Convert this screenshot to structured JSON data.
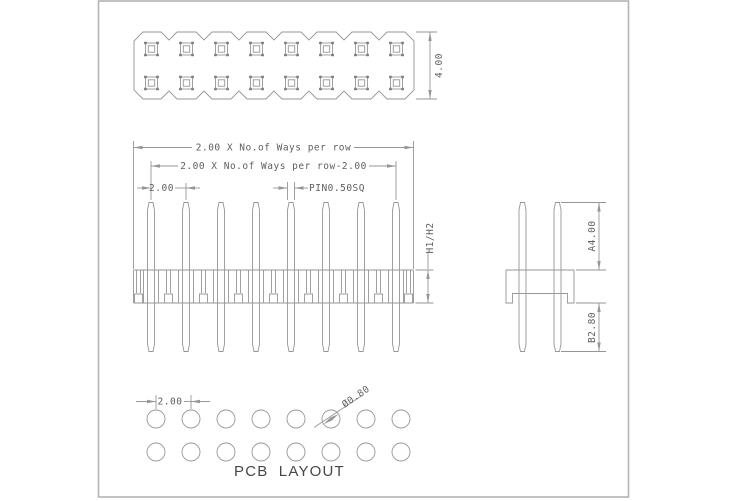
{
  "colors": {
    "line": "#969696",
    "text": "#5f5f5f",
    "accent": "#555555",
    "page_border": "#b3b3b3",
    "background": "#ffffff"
  },
  "drawing": {
    "ways_per_row": 8,
    "pin_rows": 2,
    "holes_per_row": 8,
    "hole_rows": 2
  },
  "top_view": {
    "dim_height": "4.00"
  },
  "front_view": {
    "dim_total_width": "2.00 X No.of Ways per row",
    "dim_inner_width": "2.00 X No.of Ways per row-2.00",
    "dim_pitch": "2.00",
    "dim_pin_size": "PIN0.50SQ",
    "dim_body_height": "H1/H2"
  },
  "side_view": {
    "dim_pin_above": "A4.00",
    "dim_pin_below": "B2.80"
  },
  "pcb_layout": {
    "dim_pitch": "2.00",
    "dim_hole_dia": "Ø0.80",
    "title": "PCB LAYOUT"
  }
}
